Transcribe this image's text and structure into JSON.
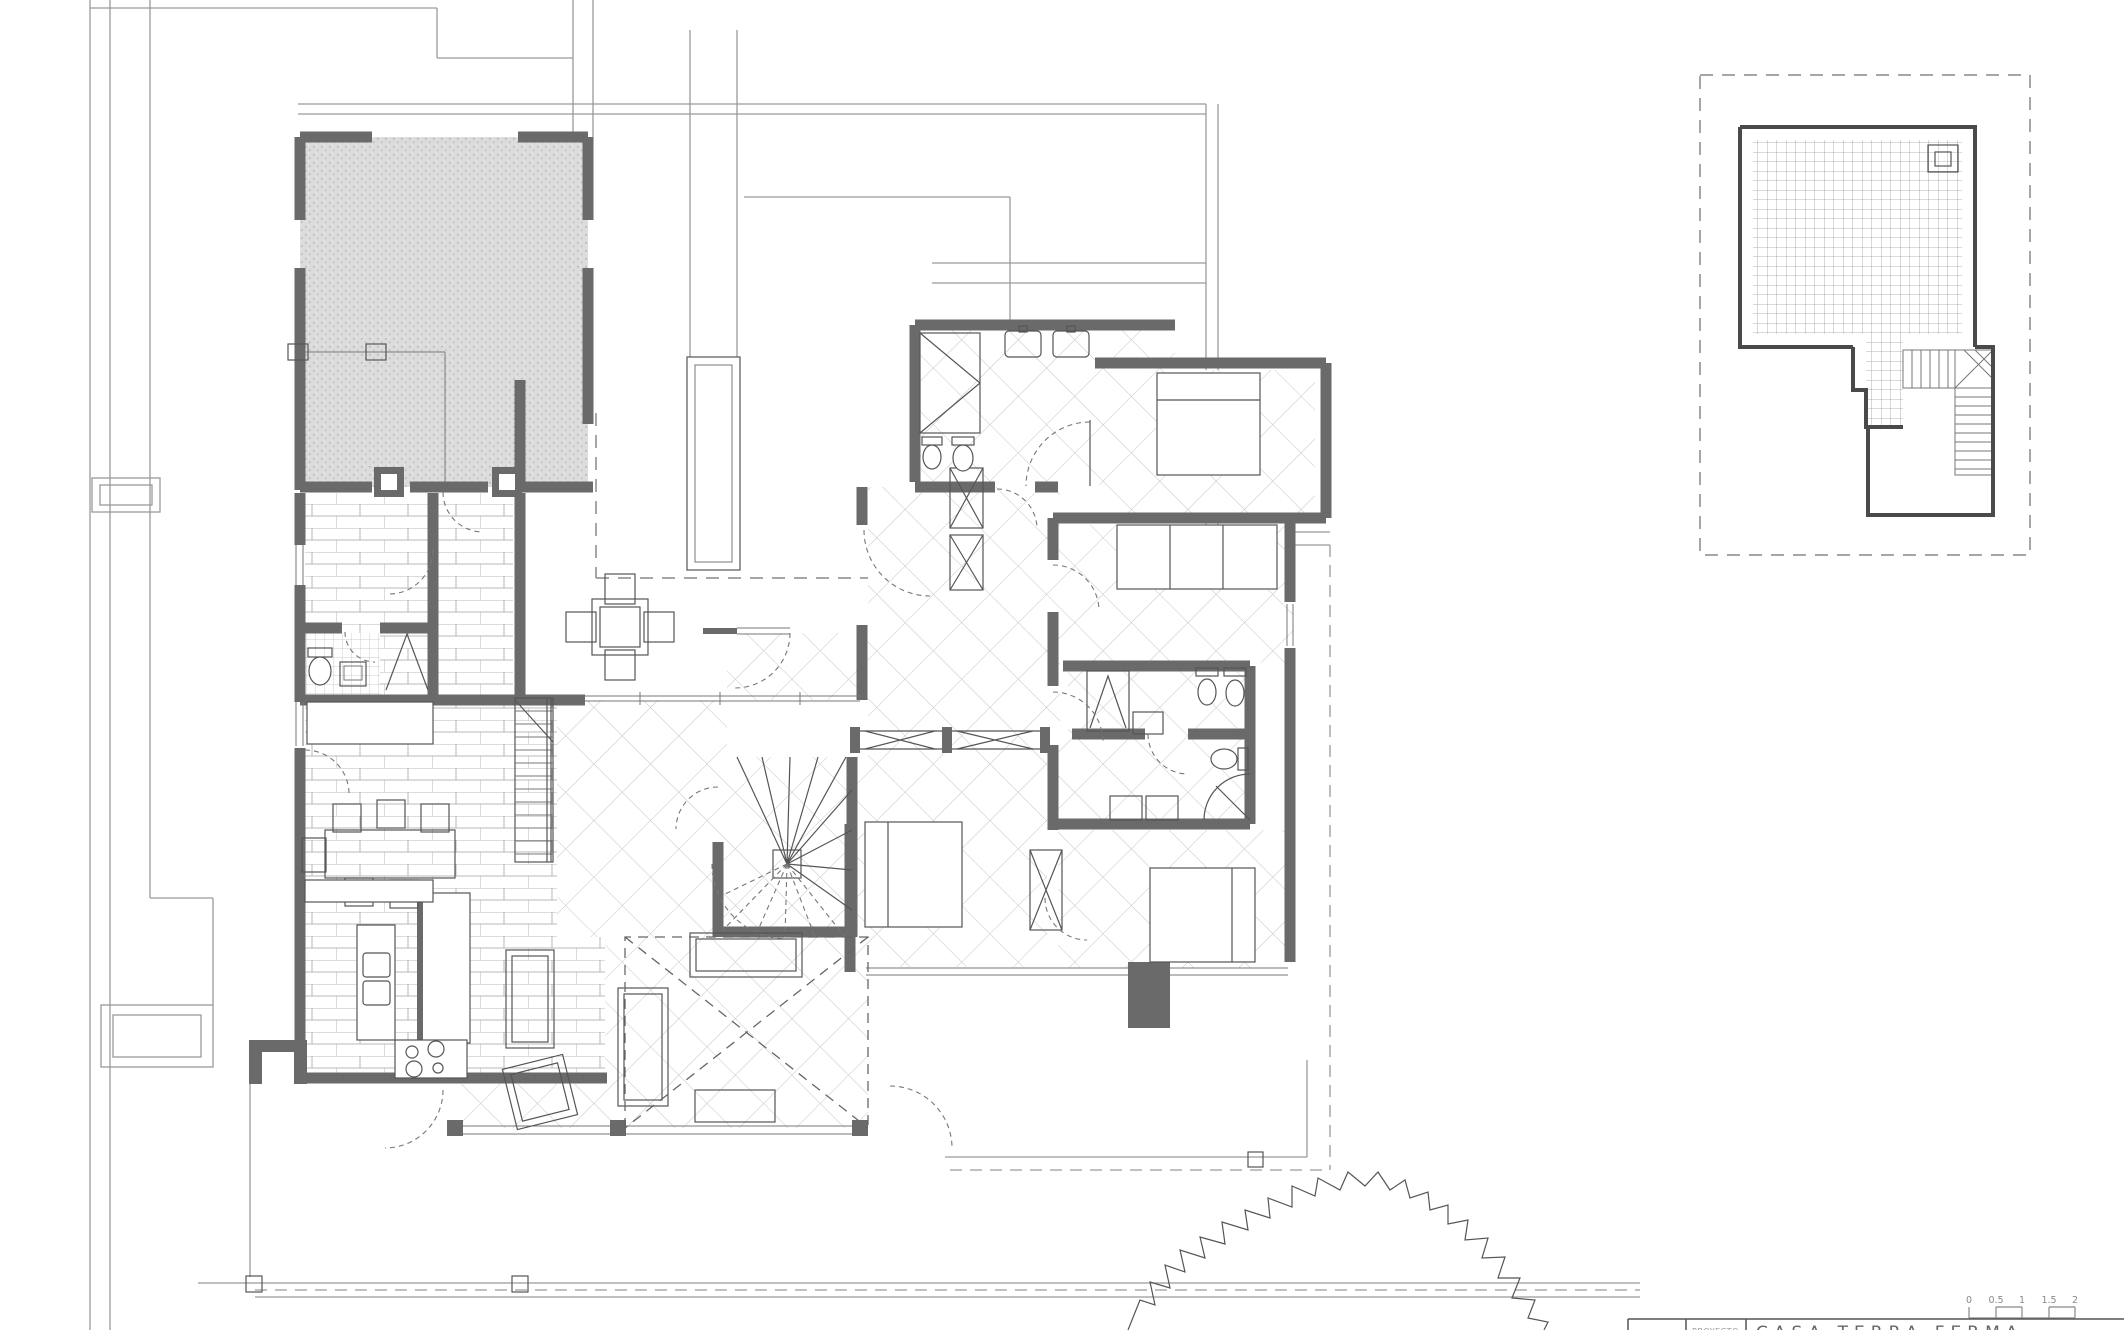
{
  "drawing": {
    "type": "architectural-floor-plan",
    "sheet_background": "#ffffff"
  },
  "title_block": {
    "project_label": "PROYECTO",
    "project_name": "CASA TERRA FERMA"
  },
  "scale_bar": {
    "labels": [
      "0",
      "0.5",
      "1",
      "1.5",
      "2"
    ]
  },
  "colors": {
    "wall": "#6a6a6a",
    "line": "#555555",
    "site_line": "#9a9a9a",
    "hatch": "#c6c6c6",
    "terrace_fill": "#dcdcdc"
  }
}
